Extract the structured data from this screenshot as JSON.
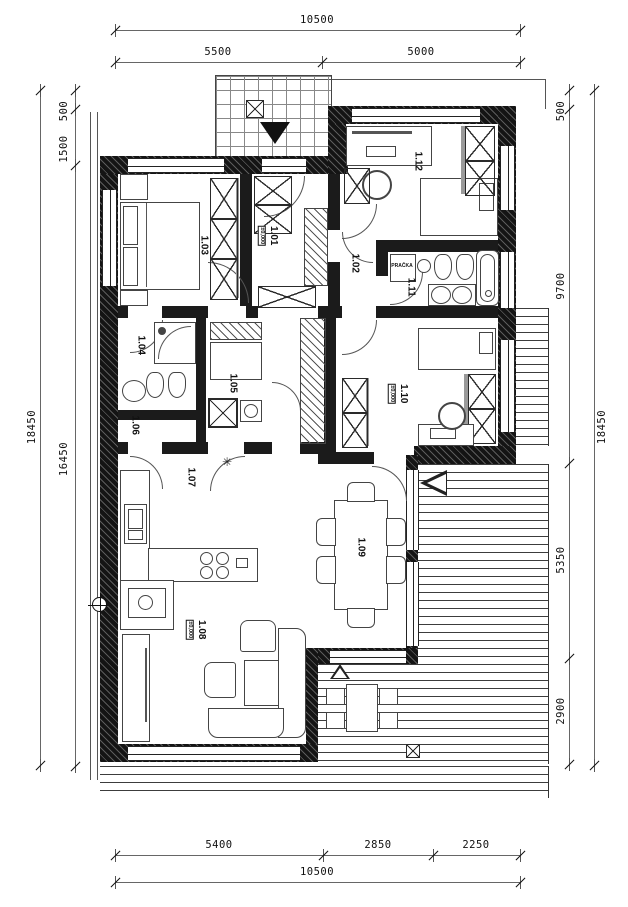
{
  "dimensions": {
    "top": {
      "total": "10500",
      "seg1": "5500",
      "seg2": "5000"
    },
    "bottom": {
      "total": "10500",
      "seg1": "5400",
      "seg2": "2850",
      "seg3": "2250"
    },
    "left": {
      "total": "18450",
      "seg1": "500",
      "seg2": "1500",
      "seg3": "16450"
    },
    "right": {
      "total": "18450",
      "seg1": "500",
      "seg2": "9700",
      "seg3": "5350",
      "seg4": "2900"
    }
  },
  "rooms": {
    "r101": {
      "id": "1.01",
      "elevation": "±0,000"
    },
    "r102": {
      "id": "1.02"
    },
    "r103": {
      "id": "1.03"
    },
    "r104": {
      "id": "1.04"
    },
    "r105": {
      "id": "1.05"
    },
    "r106": {
      "id": "1.06"
    },
    "r107": {
      "id": "1.07"
    },
    "r108": {
      "id": "1.08",
      "elevation": "±0,000"
    },
    "r109": {
      "id": "1.09"
    },
    "r110": {
      "id": "1.10",
      "elevation": "±0,000"
    },
    "r111": {
      "id": "1.11"
    },
    "r112": {
      "id": "1.12"
    }
  },
  "appliances": {
    "washer": "PRAČKA"
  },
  "symbols": {
    "snowflake": "✳"
  },
  "colors": {
    "wall": "#141414",
    "line": "#444",
    "dim": "#666",
    "wardrobe_back": "#9a9a9a"
  }
}
